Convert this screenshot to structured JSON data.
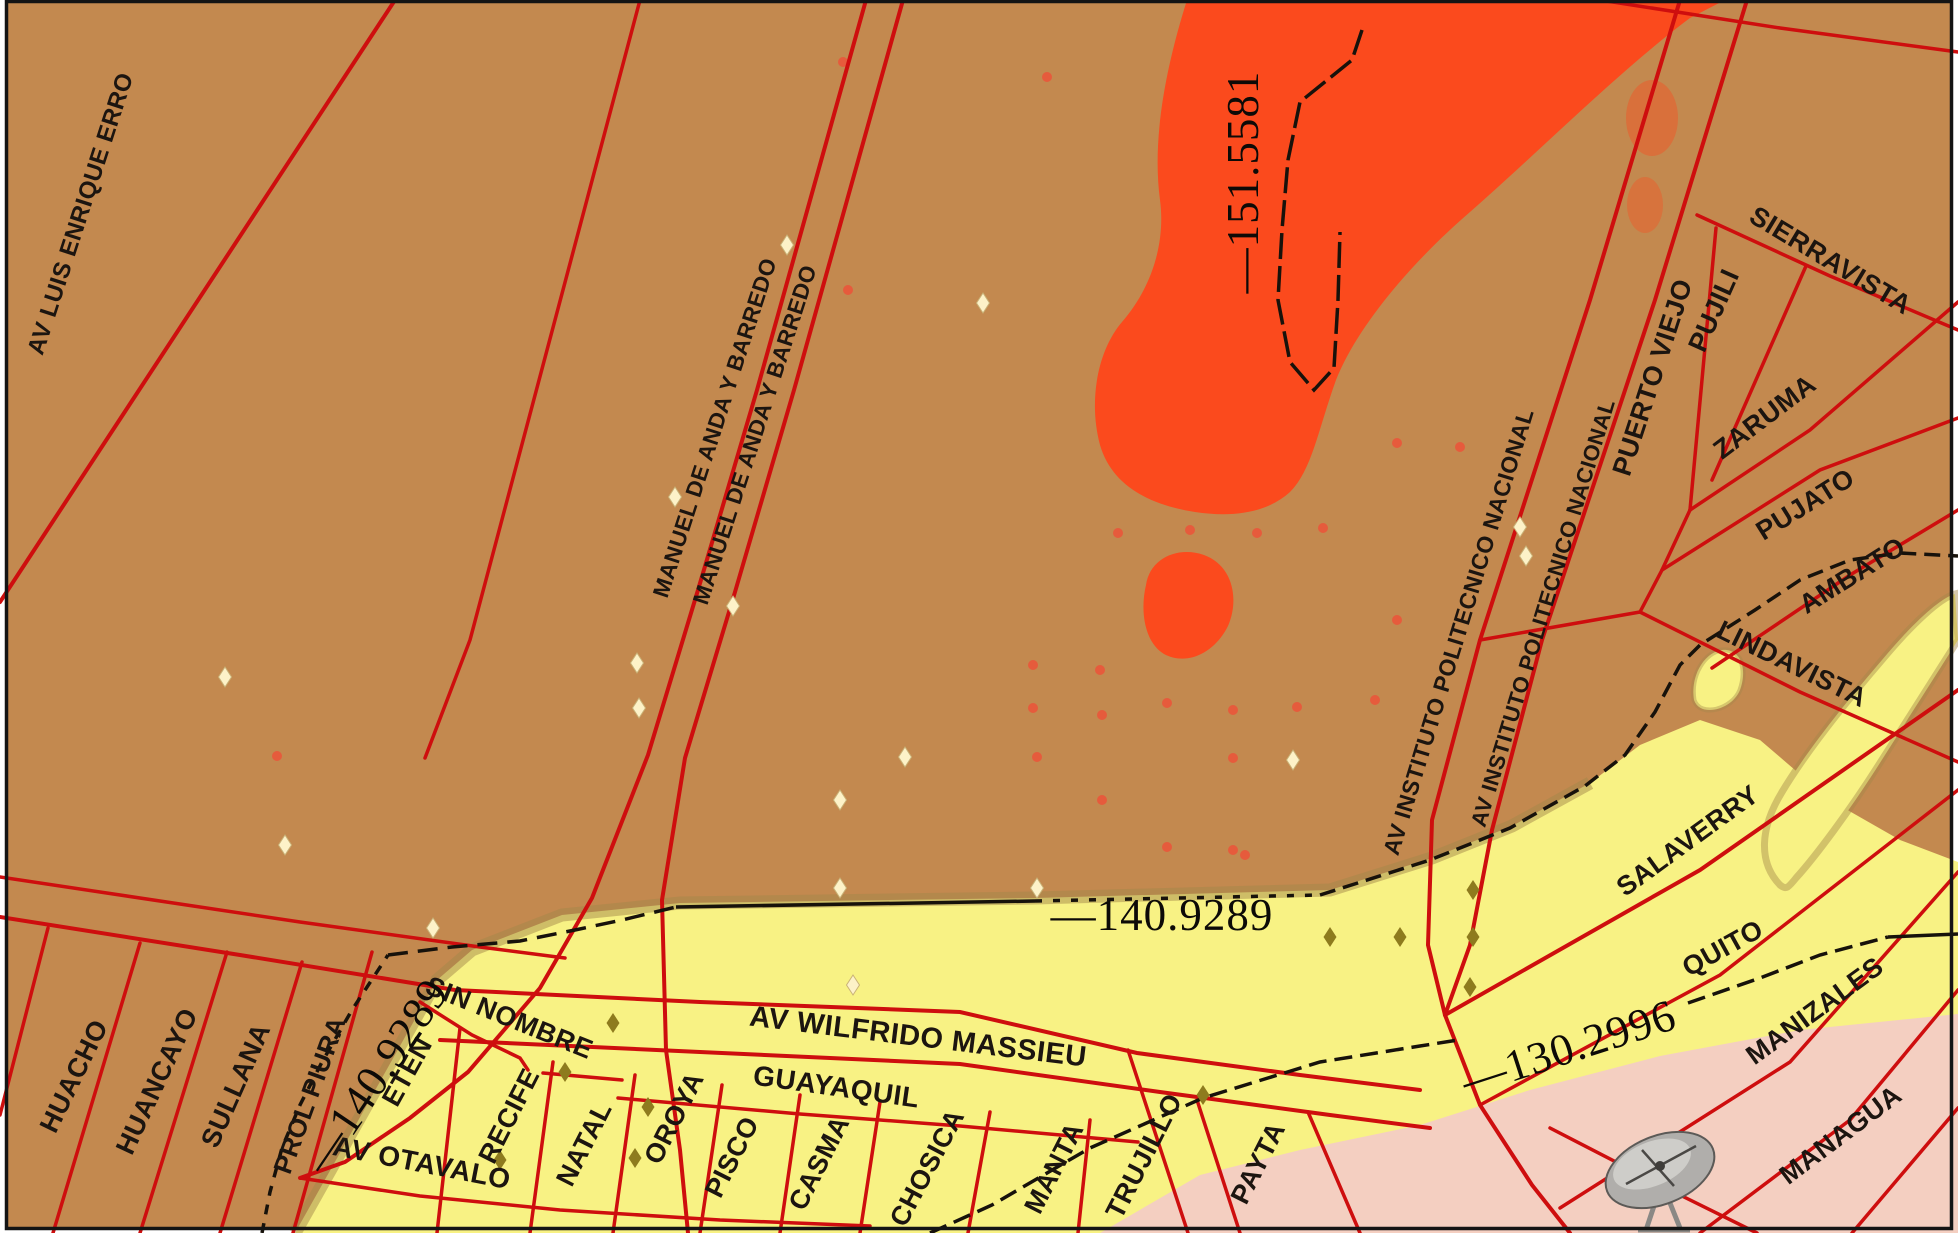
{
  "palette": {
    "background_brown": "#c3894f",
    "zone_yellow": "#f8f284",
    "zone_red_anomaly": "#fb4a1d",
    "zone_pink": "#f4cfc1",
    "street_red": "#ce0e0e",
    "contour_black": "#17120b",
    "marker_cream": "#fdf2c8",
    "marker_olive": "#8e7b1e"
  },
  "icons": [
    {
      "name": "satellite-dish-icon"
    }
  ],
  "streets": [
    {
      "label": "AV LUIS ENRIQUE ERRO"
    },
    {
      "label": "MANUEL DE ANDA Y BARREDO"
    },
    {
      "label": "MANUEL DE ANDA Y BARREDO"
    },
    {
      "label": "AV INSTITUTO POLITECNICO NACIONAL"
    },
    {
      "label": "AV INSTITUTO POLITECNICO NACIONAL"
    },
    {
      "label": "SIERRAVISTA"
    },
    {
      "label": "PUJILI"
    },
    {
      "label": "PUERTO VIEJO"
    },
    {
      "label": "ZARUMA"
    },
    {
      "label": "PUJATO"
    },
    {
      "label": "AMBATO"
    },
    {
      "label": "LINDAVISTA"
    },
    {
      "label": "SALAVERRY"
    },
    {
      "label": "QUITO"
    },
    {
      "label": "MANIZALES"
    },
    {
      "label": "MANAGUA"
    },
    {
      "label": "HUACHO"
    },
    {
      "label": "HUANCAYO"
    },
    {
      "label": "SULLANA"
    },
    {
      "label": "PROL PIURA"
    },
    {
      "label": "SIN NOMBRE"
    },
    {
      "label": "AV OTAVALO"
    },
    {
      "label": "ETEN"
    },
    {
      "label": "RECIFE"
    },
    {
      "label": "NATAL"
    },
    {
      "label": "OROYA"
    },
    {
      "label": "PISCO"
    },
    {
      "label": "CASMA"
    },
    {
      "label": "CHOSICA"
    },
    {
      "label": "MANTA"
    },
    {
      "label": "TRUJILLO"
    },
    {
      "label": "PAYTA"
    },
    {
      "label": "AV WILFRIDO MASSIEU"
    },
    {
      "label": "GUAYAQUIL"
    }
  ],
  "contours": [
    {
      "text": "—151.5581"
    },
    {
      "text": "—140.9289"
    },
    {
      "text": "—140.9289"
    },
    {
      "text": "—130.2996"
    }
  ]
}
